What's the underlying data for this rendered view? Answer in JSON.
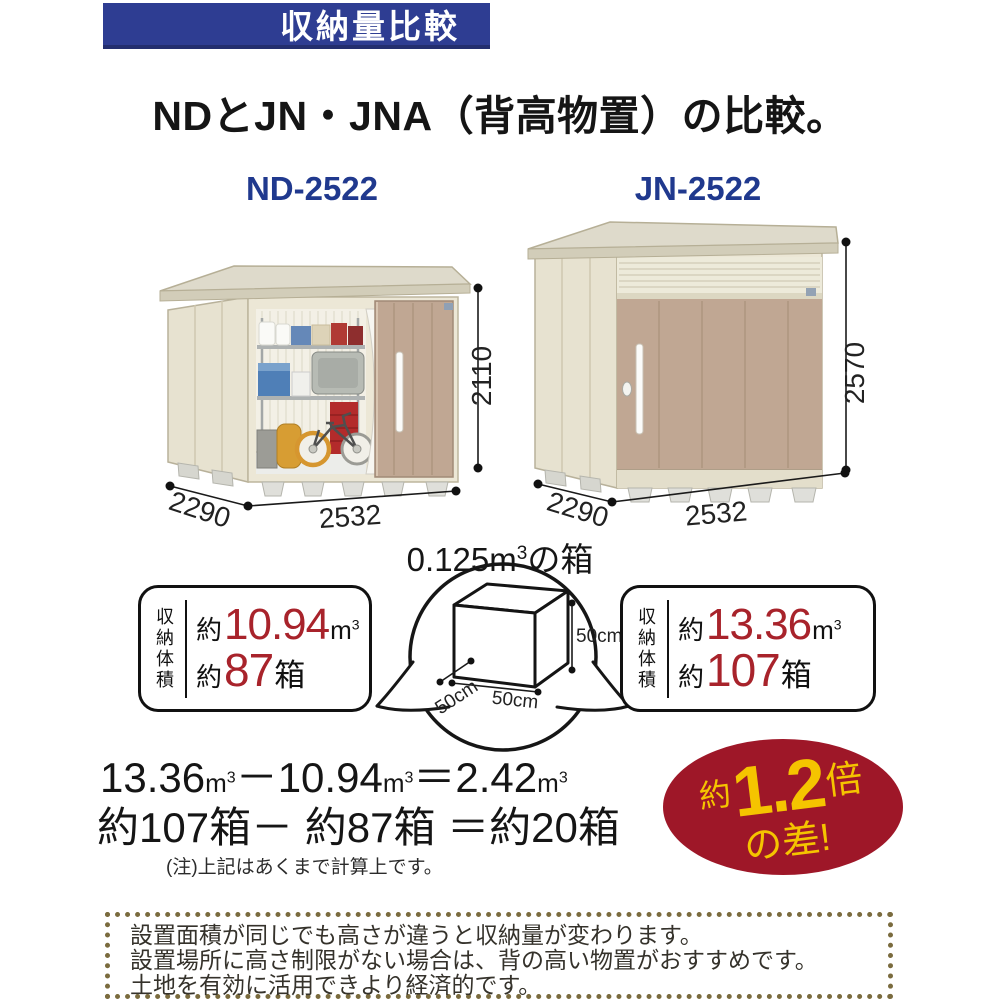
{
  "colors": {
    "header_blue": "#2e3d92",
    "model_navy": "#20398e",
    "number_red": "#a8232b",
    "badge_red": "#9e1728",
    "badge_yellow": "#f5c400",
    "dotted_border": "#7a6b3e",
    "shed_cream": "#ece7d6",
    "door_tan": "#c0a793"
  },
  "header": {
    "banner_label": "収納量比較",
    "title": "NDとJN・JNA（背高物置）の比較。"
  },
  "sheds": {
    "left": {
      "model": "ND-2522",
      "width": "2532",
      "depth": "2290",
      "height": "2110"
    },
    "right": {
      "model": "JN-2522",
      "width": "2532",
      "depth": "2290",
      "height": "2570"
    }
  },
  "reference_box": {
    "label": "0.125m",
    "label_sup": "3",
    "label_suffix": "の箱",
    "height": "50cm",
    "width": "50cm",
    "depth": "50cm"
  },
  "capacity": {
    "vertical_label": "収納体積",
    "approx": "約",
    "volume_unit": "m",
    "volume_unit_sup": "3",
    "boxes_unit": "箱",
    "left": {
      "volume": "10.94",
      "boxes": "87"
    },
    "right": {
      "volume": "13.36",
      "boxes": "107"
    }
  },
  "calculation": {
    "minuend": "13.36",
    "subtrahend": "10.94",
    "difference": "2.42",
    "unit": "m",
    "unit_sup": "3",
    "minus": "－",
    "equals": "＝",
    "boxes_line": "約107箱－ 約87箱 ＝約20箱",
    "note": "(注)上記はあくまで計算上です。"
  },
  "badge": {
    "prefix": "約",
    "value": "1.2",
    "suffix": "倍",
    "second_line": "の差!"
  },
  "footer": {
    "lines": [
      "設置面積が同じでも高さが違うと収納量が変わります。",
      "設置場所に高さ制限がない場合は、背の高い物置がおすすめです。",
      "土地を有効に活用できより経済的です。"
    ]
  }
}
